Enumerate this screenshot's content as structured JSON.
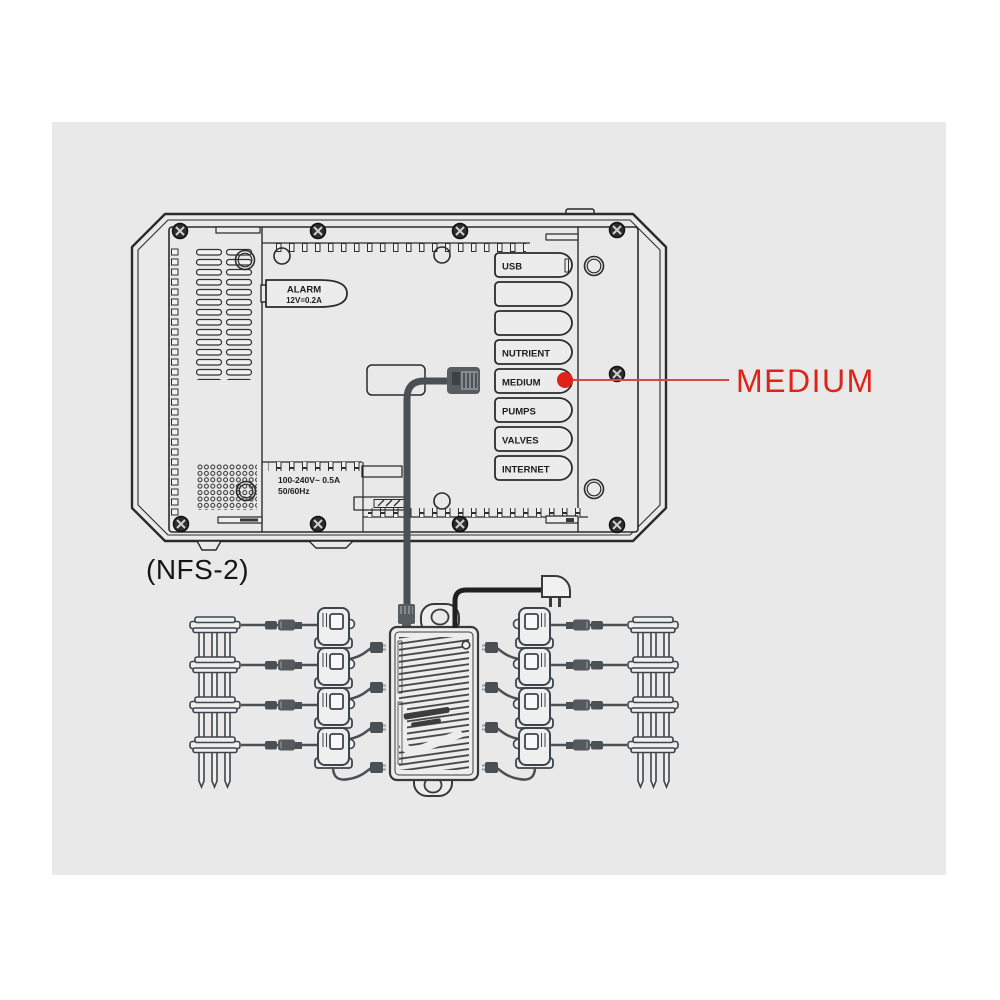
{
  "colors": {
    "canvas_bg": "#e9e9e9",
    "line_ink": "#2b2b2b",
    "cable_gray": "#4b5055",
    "accent_red": "#e02318"
  },
  "device": {
    "model": "(NFS-2)",
    "alarm": {
      "title": "ALARM",
      "rating": "12V=0.2A"
    },
    "power_rating": {
      "line1": "100-240V~ 0.5A",
      "line2": "50/60Hz"
    },
    "ports": {
      "labels": [
        "USB",
        "",
        "",
        "NUTRIENT",
        "MEDIUM",
        "PUMPS",
        "VALVES",
        "INTERNET"
      ]
    }
  },
  "callout": {
    "label": "MEDIUM"
  }
}
